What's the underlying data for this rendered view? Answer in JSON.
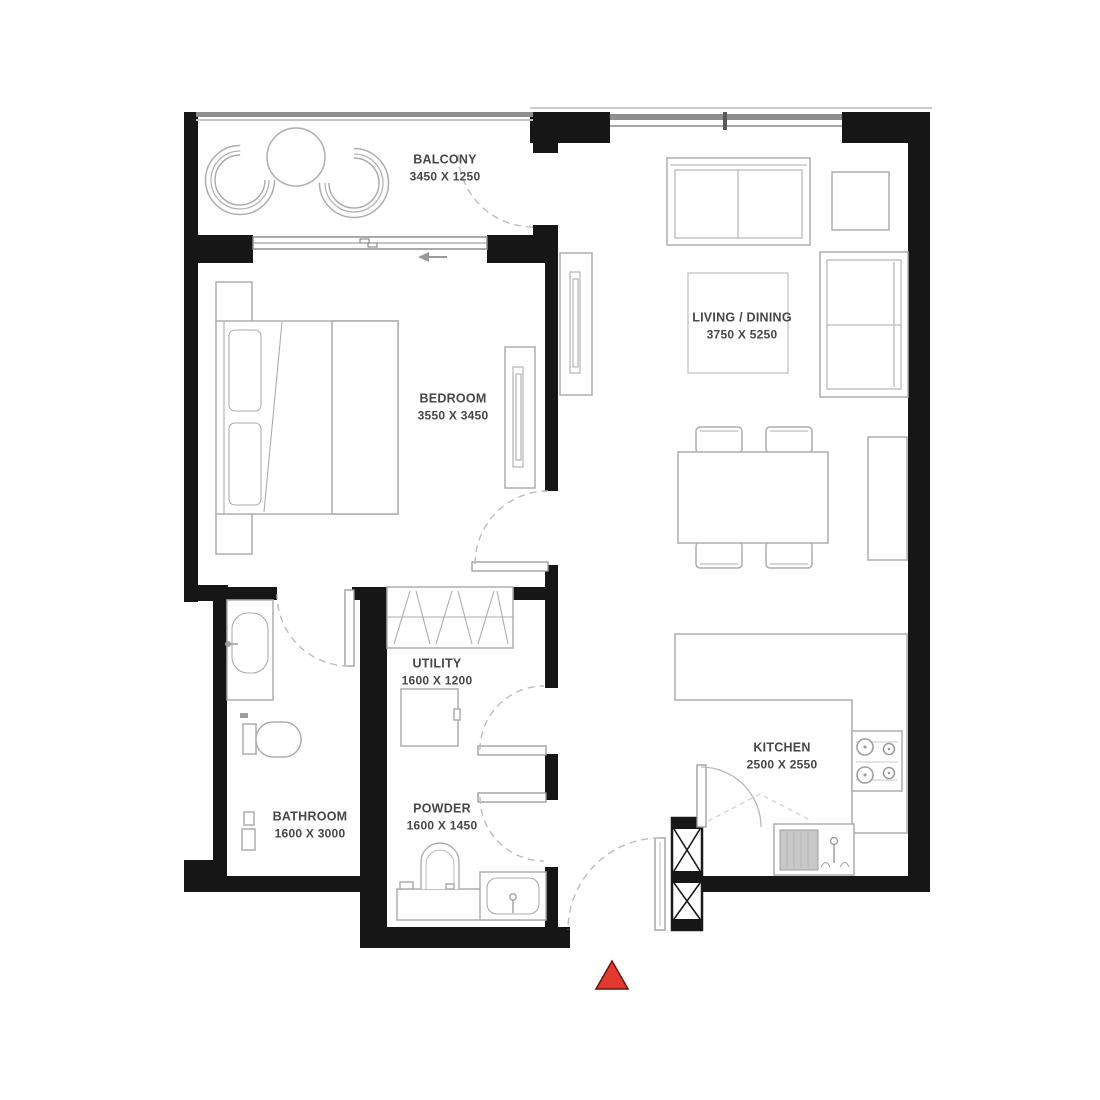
{
  "plan": {
    "title": "apartment-floor-plan",
    "rooms": [
      {
        "id": "balcony",
        "name": "BALCONY",
        "dims": "3450 X 1250"
      },
      {
        "id": "bedroom",
        "name": "BEDROOM",
        "dims": "3550 X 3450"
      },
      {
        "id": "living_dining",
        "name": "LIVING / DINING",
        "dims": "3750 X 5250"
      },
      {
        "id": "utility",
        "name": "UTILITY",
        "dims": "1600 X 1200"
      },
      {
        "id": "bathroom",
        "name": "BATHROOM",
        "dims": "1600 X 3000"
      },
      {
        "id": "powder",
        "name": "POWDER",
        "dims": "1600 X 1450"
      },
      {
        "id": "kitchen",
        "name": "KITCHEN",
        "dims": "2500 X 2550"
      }
    ],
    "colors": {
      "wall": "#161616",
      "furniture_line": "#adadad",
      "label_text": "#474747",
      "entrance_marker": "#e23a2e",
      "entrance_marker_border": "#6e120b"
    }
  }
}
